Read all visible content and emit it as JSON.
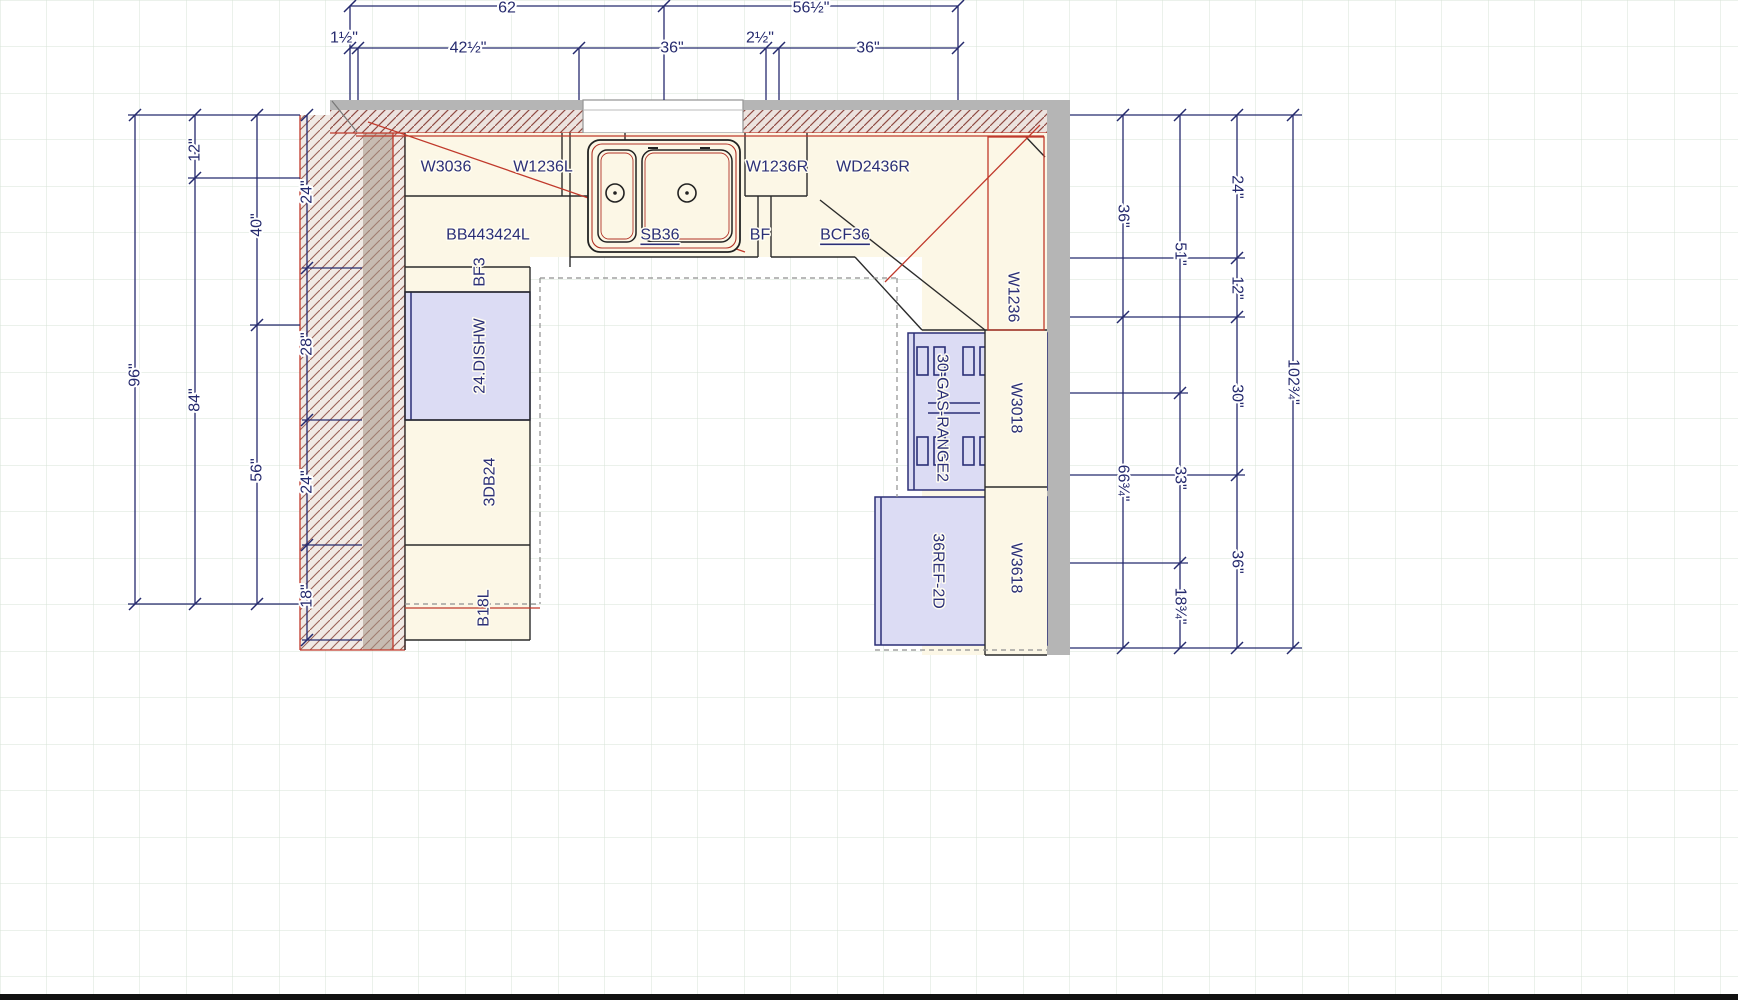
{
  "title": "Kitchen floor plan drawing",
  "colors": {
    "dimension_text": "#252a6e",
    "wall_hatch": "#8f4a42",
    "counter_red": "#c0392b",
    "appliance_fill": "#dcdcf4",
    "cabinet_fill": "#fcf7e6",
    "wall_gray": "#b5b5b5",
    "grid_green": "#d7e3d7"
  },
  "cabinets": {
    "wall": {
      "w3036": "W3036",
      "w1236l": "W1236L",
      "w1236r": "W1236R",
      "wd2436r": "WD2436R",
      "w1236": "W1236",
      "w3018": "W3018",
      "w3618": "W3618"
    },
    "base": {
      "bb443424l": "BB443424L",
      "sb36": "SB36",
      "bf": "BF",
      "bcf36": "BCF36",
      "bf3": "BF3",
      "db24": "3DB24",
      "b18l": "B18L"
    },
    "appliances": {
      "dishwasher": "24.DISHW",
      "range": "30-GAS-RANGE2",
      "fridge": "36REF-2D"
    }
  },
  "dimensions": {
    "top": {
      "overall": [
        "62",
        "56½\""
      ],
      "segments": [
        "1½\"",
        "42½\"",
        "36\"",
        "2½\"",
        "36\""
      ]
    },
    "left": {
      "overall": "96\"",
      "col2": [
        "12\"",
        "84\""
      ],
      "col3": [
        "40\"",
        "56\""
      ],
      "wall_segments": [
        "24\"",
        "28\"",
        "24\"",
        "18\""
      ]
    },
    "right": {
      "col1": [
        "36\"",
        "66¾\""
      ],
      "col2": [
        "51\"",
        "33\"",
        "18¾\""
      ],
      "col3": [
        "24\"",
        "12\"",
        "30\"",
        "36\""
      ],
      "overall": "102¾\""
    }
  }
}
